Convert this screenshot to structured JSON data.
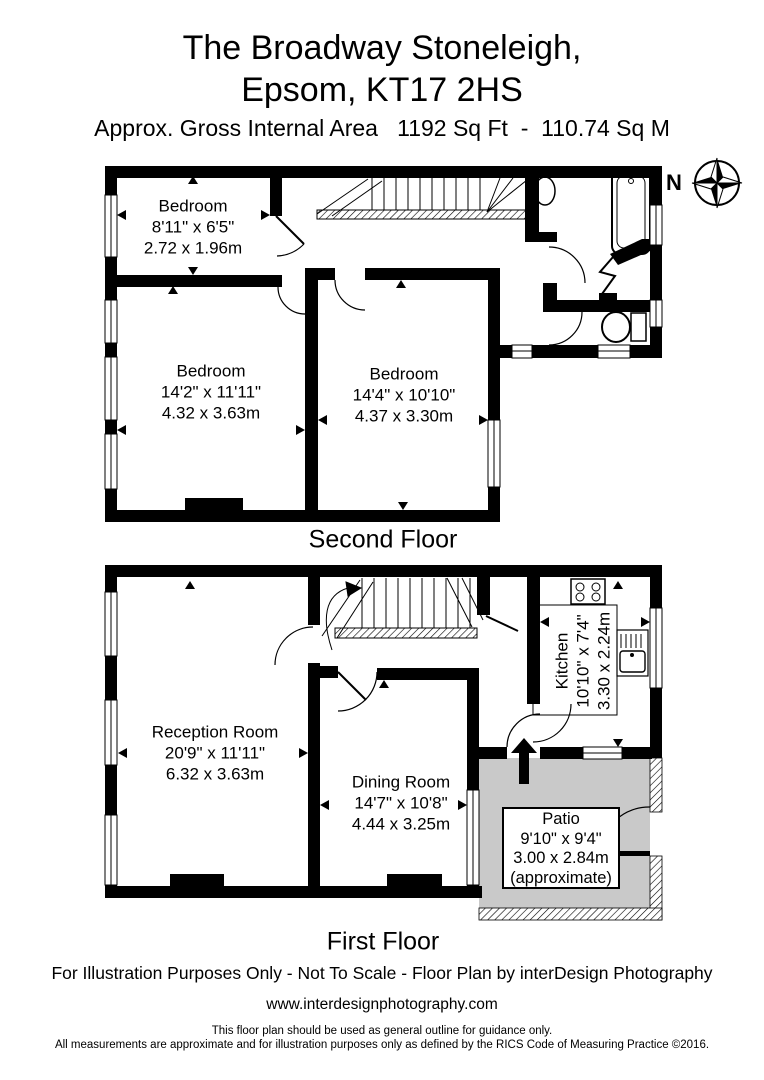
{
  "header": {
    "title_line1": "The Broadway Stoneleigh,",
    "title_line2": "Epsom, KT17 2HS",
    "area_line": "Approx. Gross Internal Area   1192 Sq Ft  -  110.74 Sq M"
  },
  "compass": {
    "north_label": "N"
  },
  "floors": [
    {
      "label": "Second Floor",
      "rooms": [
        {
          "name": "Bedroom",
          "imperial": "8'11\" x 6'5\"",
          "metric": "2.72 x 1.96m"
        },
        {
          "name": "Bedroom",
          "imperial": "14'2\" x 11'11\"",
          "metric": "4.32 x 3.63m"
        },
        {
          "name": "Bedroom",
          "imperial": "14'4\" x 10'10\"",
          "metric": "4.37 x 3.30m"
        }
      ]
    },
    {
      "label": "First Floor",
      "rooms": [
        {
          "name": "Reception Room",
          "imperial": "20'9\" x 11'11\"",
          "metric": "6.32 x 3.63m"
        },
        {
          "name": "Dining Room",
          "imperial": "14'7\" x 10'8\"",
          "metric": "4.44 x 3.25m"
        },
        {
          "name": "Kitchen",
          "imperial": "10'10\" x 7'4\"",
          "metric": "3.30 x 2.24m"
        },
        {
          "name": "Patio",
          "imperial": "9'10\" x 9'4\"",
          "metric": "3.00 x 2.84m",
          "note": "(approximate)"
        }
      ]
    }
  ],
  "footer": {
    "line1": "For Illustration Purposes Only - Not To Scale - Floor Plan by interDesign Photography",
    "website": "www.interdesignphotography.com",
    "disclaimer1": "This floor plan should be used as general outline for guidance only.",
    "disclaimer2": "All measurements are approximate and for illustration purposes only as defined by the RICS Code of Measuring Practice ©2016."
  },
  "icons": {
    "compass": "compass-rose",
    "stairs": "staircase",
    "bathtub": "bathtub",
    "toilet": "toilet",
    "basin": "wash-basin",
    "hob": "cooker-hob",
    "kitchen_sink": "sink-with-drainer",
    "entrance_arrow": "entrance-up-arrow"
  },
  "colors": {
    "wall": "#000000",
    "patio_fill": "#c9c9c9",
    "background": "#ffffff",
    "window": "#ffffff"
  }
}
